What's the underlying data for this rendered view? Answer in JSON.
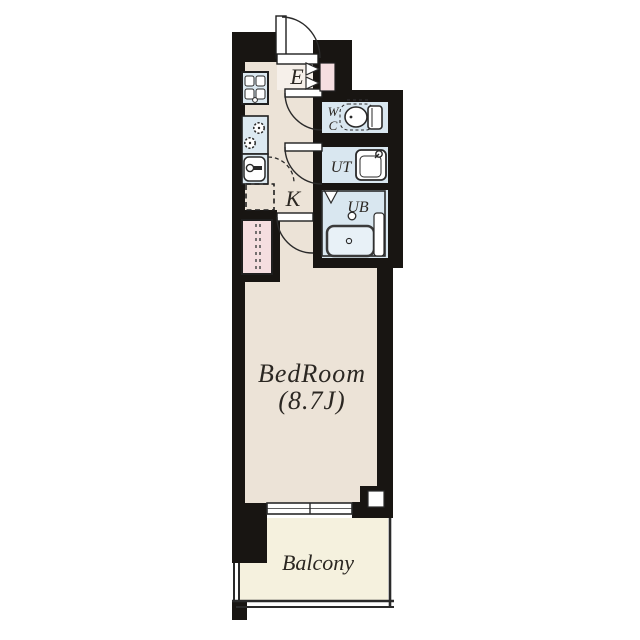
{
  "plan": {
    "labels": {
      "entrance": "E",
      "kitchen": "K",
      "wc_line1": "W",
      "wc_line2": "C",
      "utility": "UT",
      "unit_bath": "UB",
      "bedroom": "BedRoom",
      "bedroom_size": "(8.7J)",
      "balcony": "Balcony"
    },
    "colors": {
      "wall": "#181512",
      "floor_main": "#ece3d7",
      "floor_entry": "#f6f0ea",
      "floor_wet": "#d9e7f0",
      "floor_balcony": "#f5f1de",
      "closet_pink": "#f5dee0",
      "fixture_blue": "#dce9f1",
      "tub_blue": "#e8f1f7",
      "line": "#2a2a2a",
      "text": "#2b2722",
      "background": "#ffffff"
    },
    "icons": {
      "entrance_door": "quarter-arc-door-icon",
      "shoe_cabinet_door": "double-triangle-icon",
      "toilet": "toilet-icon",
      "wash_basin": "basin-faucet-icon",
      "bathtub": "bathtub-icon",
      "stove": "stove-grate-icon",
      "gas_burners": "burner-flame-icon",
      "kitchen_sink": "sink-faucet-icon",
      "refrigerator_space": "dashed-square-icon",
      "hanger_pipe": "dashed-pipe-icon",
      "window": "double-pane-window-icon",
      "pillar": "pillar-icon"
    }
  }
}
